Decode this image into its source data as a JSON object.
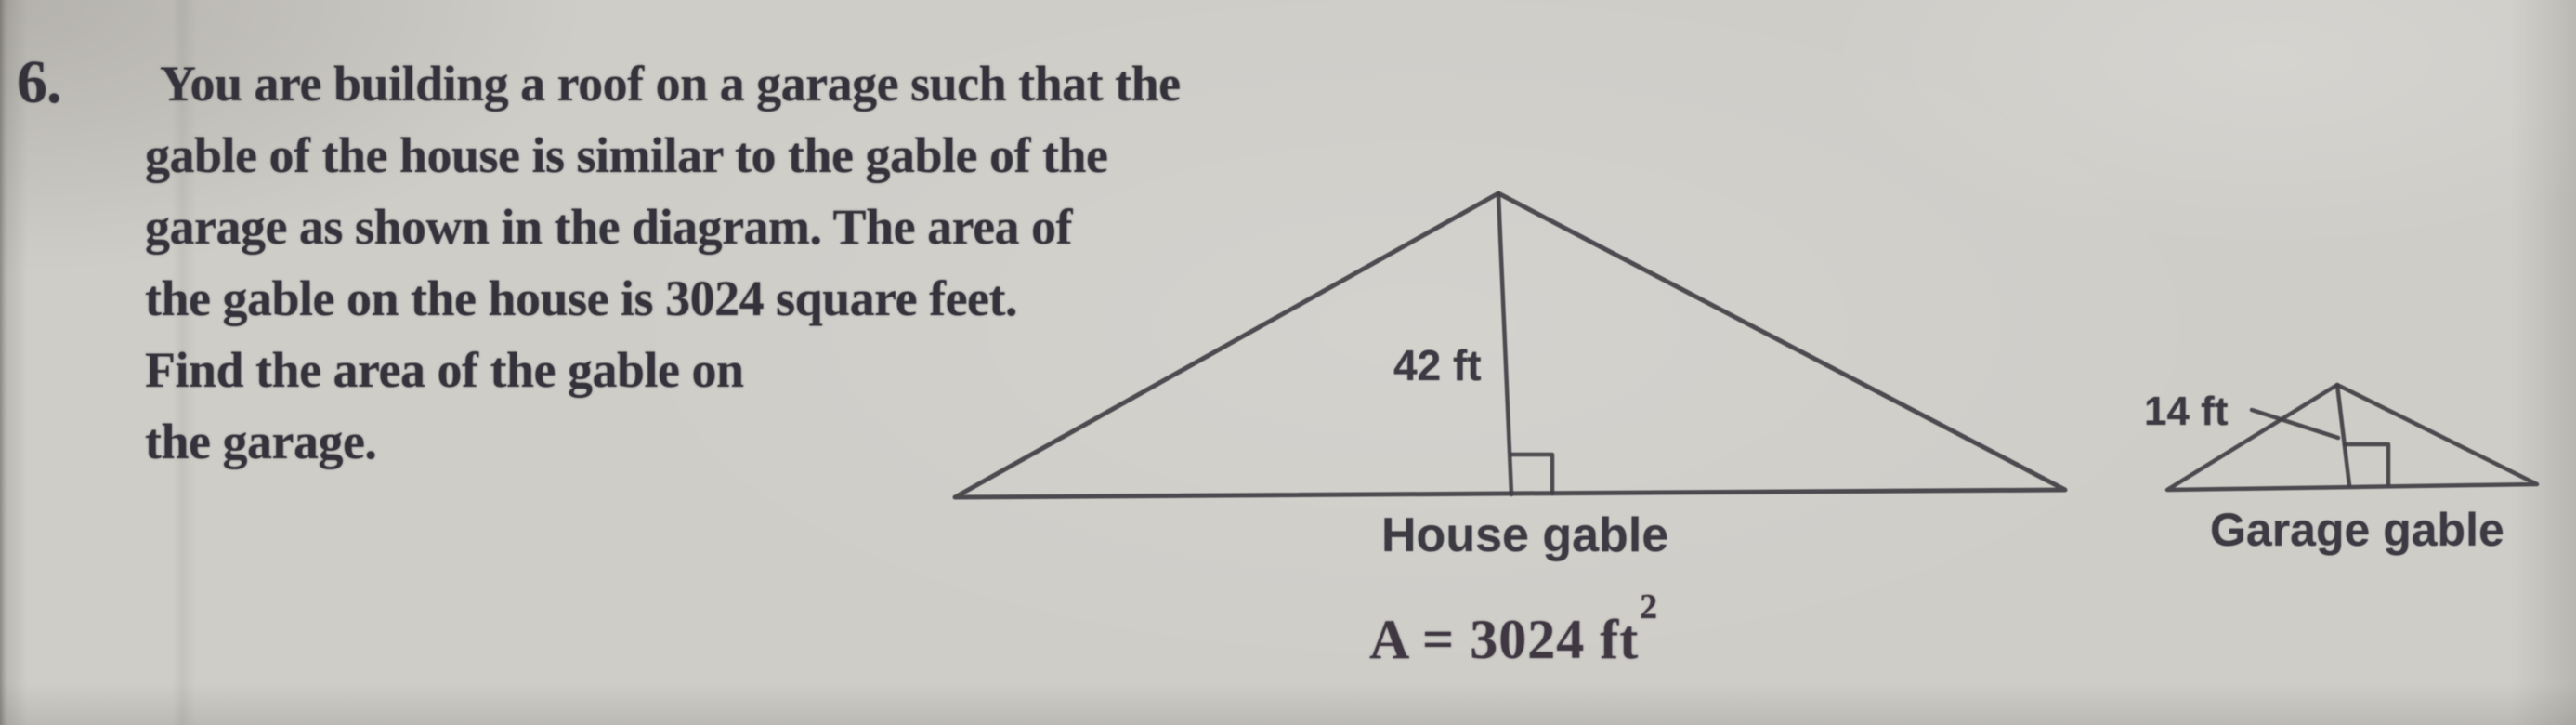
{
  "problem": {
    "number": "6.",
    "lines": [
      "You are building a roof on a garage such that the",
      "gable of the house is similar to the gable of the",
      "garage as shown in the diagram. The area of",
      "the gable on the house is 3024 square feet.",
      "Find the area of the gable on",
      "the garage."
    ]
  },
  "diagram": {
    "house": {
      "height_label": "42 ft",
      "caption": "House gable",
      "area_prefix": "A = 3024 ft",
      "area_exponent": "2"
    },
    "garage": {
      "height_label": "14 ft",
      "caption": "Garage gable"
    }
  },
  "colors": {
    "paper": "#cfcdc8",
    "ink_text": "#34323a",
    "ink_line": "#413f44"
  }
}
